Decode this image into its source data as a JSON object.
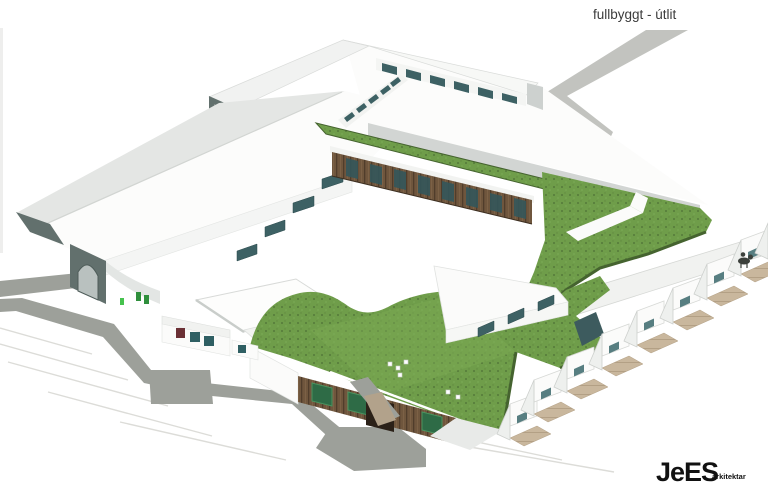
{
  "header": {
    "title": "fullbyggt - útlit"
  },
  "branding": {
    "logo_main": "JeES",
    "logo_suffix": "arkitektar"
  },
  "palette": {
    "bg": "#ffffff",
    "roofGray": "#e4e6e4",
    "roofWhite": "#f7f8f6",
    "wallWhite": "#fbfbfa",
    "wallShade": "#d6d9d7",
    "gableDark": "#62706d",
    "windowTeal": "#3d6164",
    "grass": "#6f9d4a",
    "grassDark": "#45632f",
    "grassLight": "#7cab55",
    "wood": "#6f563d",
    "woodDark": "#503d2b",
    "road": "#9da09a",
    "roadLight": "#c2c3bf",
    "floorTan": "#c9b79d",
    "faintLine": "#dcdcd8",
    "text": "#3b3b3b",
    "logo": "#111111"
  },
  "scene": {
    "description": "Axonometric architectural rendering of a school complex, fully built view",
    "elements": [
      "north-wing",
      "west-wing",
      "central-wing",
      "main-green-roof",
      "south-building",
      "southeast-wing",
      "stall-row",
      "road-network",
      "entrance-arch",
      "courtyard-canopy",
      "horse-rider-figure"
    ]
  }
}
